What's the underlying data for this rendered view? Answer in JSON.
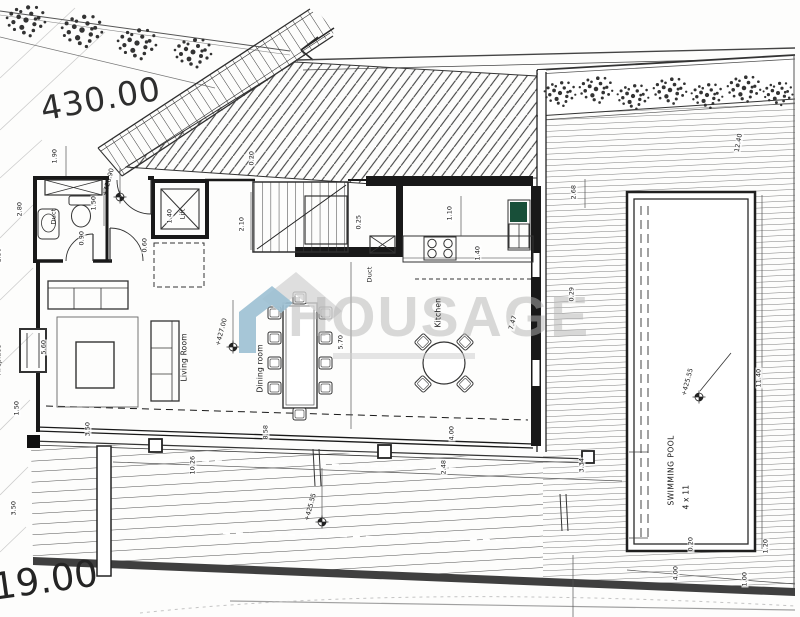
{
  "site": {
    "upper_level": "430.00",
    "lower_level": "419.00"
  },
  "watermark": {
    "brand": "HOUSAGE"
  },
  "rooms": {
    "wc_duct": "Duct",
    "lift": "Lift",
    "kitchen_duct": "Duct",
    "living_room": "Living Room",
    "dining_room": "Dining room",
    "kitchen": "Kitchen",
    "fireplace": "Fireplace",
    "swimming_pool": "SWIMMING POOL",
    "pool_size": "4 x 11"
  },
  "levels": [
    {
      "value": "+426.90"
    },
    {
      "value": "+427.00"
    },
    {
      "value": "+425.55"
    },
    {
      "value": "+425.55"
    }
  ],
  "dimensions": [
    {
      "value": "1.90"
    },
    {
      "value": "1.50"
    },
    {
      "value": "0.90"
    },
    {
      "value": "1.40"
    },
    {
      "value": "0.60"
    },
    {
      "value": "2.80"
    },
    {
      "value": "1.50"
    },
    {
      "value": "0.20"
    },
    {
      "value": "2.10"
    },
    {
      "value": "0.25"
    },
    {
      "value": "1.10"
    },
    {
      "value": "1.40"
    },
    {
      "value": "2.68"
    },
    {
      "value": "12.40"
    },
    {
      "value": "7.47"
    },
    {
      "value": "0.29"
    },
    {
      "value": "5.70"
    },
    {
      "value": "5.60"
    },
    {
      "value": "1.50"
    },
    {
      "value": "3.50"
    },
    {
      "value": "8.58"
    },
    {
      "value": "4.00"
    },
    {
      "value": "10.26"
    },
    {
      "value": "2.48"
    },
    {
      "value": "3.34"
    },
    {
      "value": "3.50"
    },
    {
      "value": "11.40"
    },
    {
      "value": "0.20"
    },
    {
      "value": "4.00"
    },
    {
      "value": "1.00"
    },
    {
      "value": "1.20"
    }
  ]
}
